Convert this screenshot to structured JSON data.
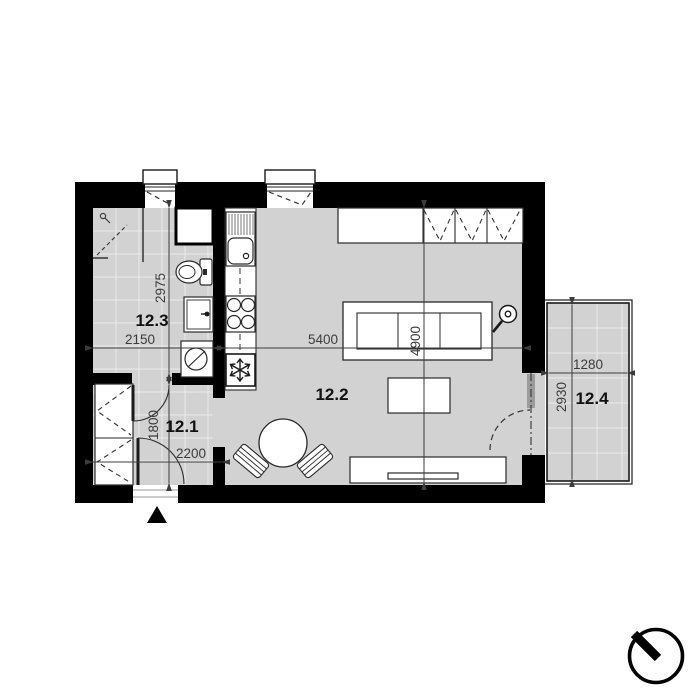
{
  "rooms": {
    "hall": {
      "label": "12.1"
    },
    "living": {
      "label": "12.2"
    },
    "bathroom": {
      "label": "12.3"
    },
    "balcony": {
      "label": "12.4"
    }
  },
  "dimensions": {
    "bathroom_height": "2975",
    "bathroom_width": "2150",
    "living_width": "5400",
    "living_height": "4900",
    "hall_height": "1800",
    "hall_width": "2200",
    "balcony_width": "1280",
    "balcony_height": "2930"
  },
  "icons": {
    "north_indicator": "north-indicator",
    "entrance_marker": "entrance-triangle",
    "fridge": "snowflake-icon",
    "washing_machine": "washer-drum-icon",
    "lamp": "floor-lamp-icon"
  },
  "colors": {
    "wall": "#000000",
    "floor": "#d2d2d2",
    "tile_line": "#ebebeb",
    "line": "#2a2a2a",
    "dim": "#3c3c3c"
  }
}
